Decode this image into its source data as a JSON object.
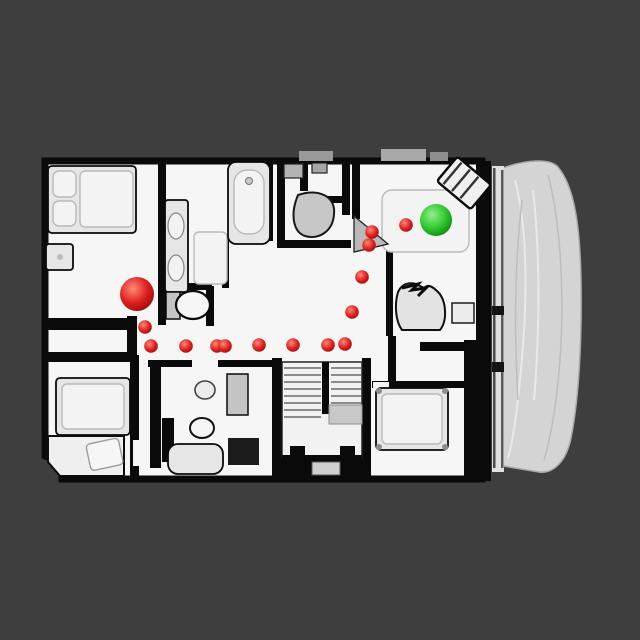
{
  "scene": {
    "description": "top-down rendered floor plan with navigation path markers",
    "background_color": "#3e3e3e",
    "floor_color": "#f6f6f6",
    "wall_color": "#0a0a0a",
    "furniture_color": "#e6e6e6",
    "furniture_dark_color": "#c4c4c4",
    "terrain_color": "#d4d4d4",
    "terrain_edge_color": "#a9a9a9"
  },
  "markers": {
    "start": {
      "x": 137,
      "y": 294,
      "r": 17,
      "color": {
        "highlight": "#ff8a76",
        "base": "#dd1f1f",
        "edge": "#8f0808"
      }
    },
    "goal": {
      "x": 436,
      "y": 220,
      "r": 16,
      "color": {
        "highlight": "#93ef8e",
        "base": "#2ec82e",
        "edge": "#0d7a0d"
      }
    },
    "waypoints": {
      "radius": 6.8,
      "color": {
        "highlight": "#ff8a76",
        "base": "#e02222",
        "edge": "#8f0808"
      },
      "points": [
        [
          145,
          327
        ],
        [
          151,
          346
        ],
        [
          186,
          346
        ],
        [
          217,
          346
        ],
        [
          225,
          346
        ],
        [
          259,
          345
        ],
        [
          293,
          345
        ],
        [
          328,
          345
        ],
        [
          345,
          344
        ],
        [
          352,
          312
        ],
        [
          362,
          277
        ],
        [
          369,
          245
        ],
        [
          372,
          232
        ],
        [
          406,
          225
        ]
      ]
    }
  }
}
